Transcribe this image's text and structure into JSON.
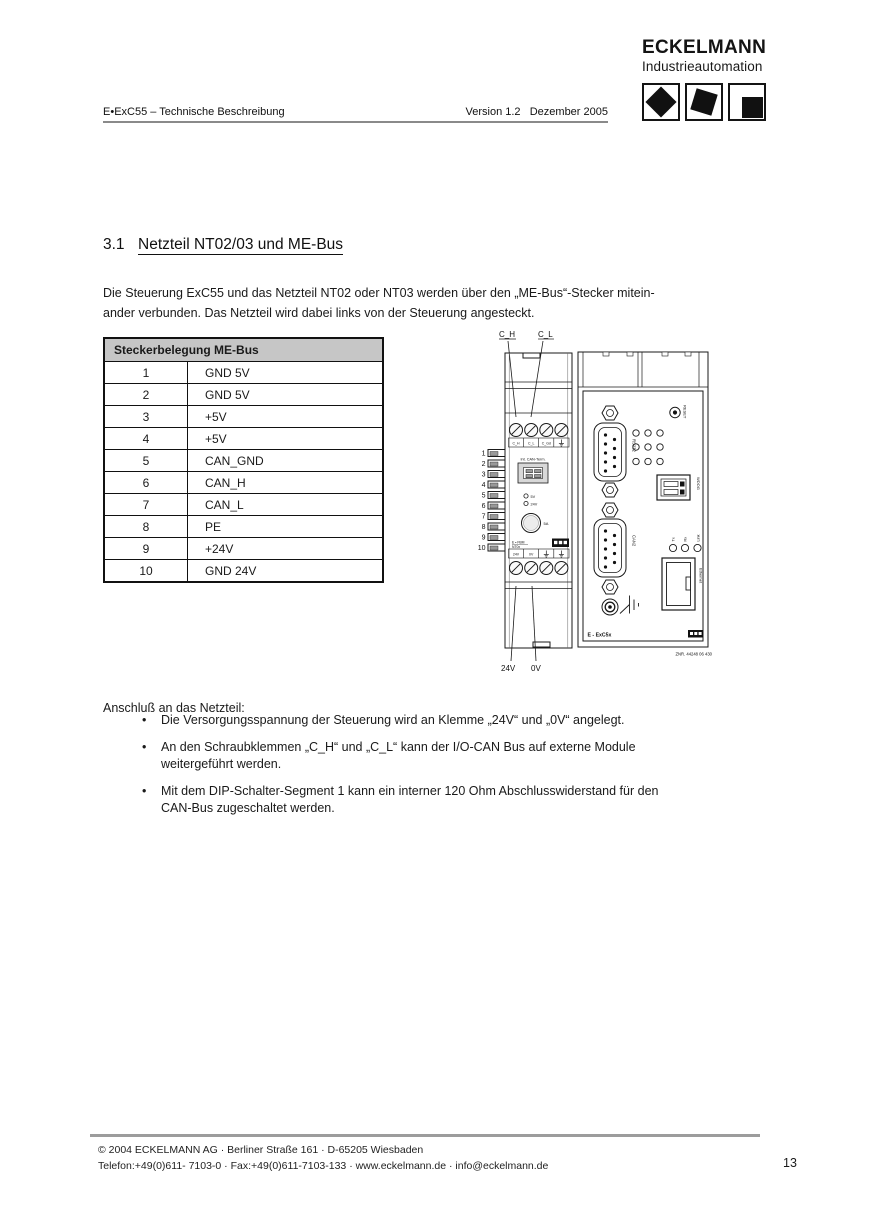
{
  "header": {
    "doc_title": "E•ExC55 – Technische Beschreibung",
    "version": "Version 1.2   Dezember 2005"
  },
  "logo": {
    "brand": "ECKELMANN",
    "subtitle": "Industrieautomation"
  },
  "section": {
    "number": "3.1",
    "title": "Netzteil NT02/03 und ME-Bus",
    "intro": "Die Steuerung ExC55 und das Netzteil NT02 oder NT03 werden über den „ME-Bus“-Stecker mitein-\nander verbunden. Das Netzteil wird dabei links von der Steuerung angesteckt."
  },
  "pin_table": {
    "header": "Steckerbelegung ME-Bus",
    "rows": [
      {
        "pin": "1",
        "signal": "GND 5V"
      },
      {
        "pin": "2",
        "signal": "GND 5V"
      },
      {
        "pin": "3",
        "signal": "+5V"
      },
      {
        "pin": "4",
        "signal": "+5V"
      },
      {
        "pin": "5",
        "signal": "CAN_GND"
      },
      {
        "pin": "6",
        "signal": "CAN_H"
      },
      {
        "pin": "7",
        "signal": "CAN_L"
      },
      {
        "pin": "8",
        "signal": "PE"
      },
      {
        "pin": "9",
        "signal": "+24V"
      },
      {
        "pin": "10",
        "signal": "GND 24V"
      }
    ]
  },
  "diagram": {
    "top_labels": {
      "ch": "C_H",
      "cl": "C_L"
    },
    "bottom_labels": {
      "v24": "24V",
      "v0": "0V"
    },
    "pins": [
      "1",
      "2",
      "3",
      "4",
      "5",
      "6",
      "7",
      "8",
      "9",
      "10"
    ],
    "left_module": {
      "terminals_top": [
        "C_H",
        "C_L",
        "C_Gd"
      ],
      "can_term": "Int. CAN-Term.",
      "led_5v": "5V",
      "led_24v": "24V",
      "fuse": "5A",
      "name_line1": "E • FBM",
      "name_line2": "NT0x",
      "terminals_bottom": [
        "24V",
        "0V"
      ]
    },
    "right_module": {
      "reset": "RESET",
      "rs232": "RS232",
      "wdog": "WDOG",
      "can2": "CAN2",
      "tx": "Tx",
      "rx": "Rx",
      "link": "Link",
      "ethernet": "Ethernet",
      "device_name": "E - ExC5x",
      "part_number": "ZNR. 44248 06 430"
    }
  },
  "body": {
    "bullet_char": "•",
    "connection_heading": "Anschluß an das Netzteil:",
    "bullets": [
      "Die Versorgungsspannung der Steuerung wird an Klemme „24V“ und „0V“ angelegt.",
      "An den Schraubklemmen „C_H“ und „C_L“ kann der I/O-CAN Bus auf externe Module\nweitergeführt werden.",
      "Mit dem DIP-Schalter-Segment 1 kann ein interner 120 Ohm Abschlusswiderstand für den\nCAN-Bus zugeschaltet werden."
    ]
  },
  "footer": {
    "line1": "©  2004 ECKELMANN AG · Berliner Straße 161 · D-65205 Wiesbaden",
    "line2": "Telefon:+49(0)611- 7103-0 · Fax:+49(0)611-7103-133 · www.eckelmann.de · info@eckelmann.de",
    "page": "13"
  },
  "colors": {
    "table_header_bg": "#c6c6c6",
    "rule_gray": "#9c9c9c",
    "ink": "#1a1a1a"
  }
}
